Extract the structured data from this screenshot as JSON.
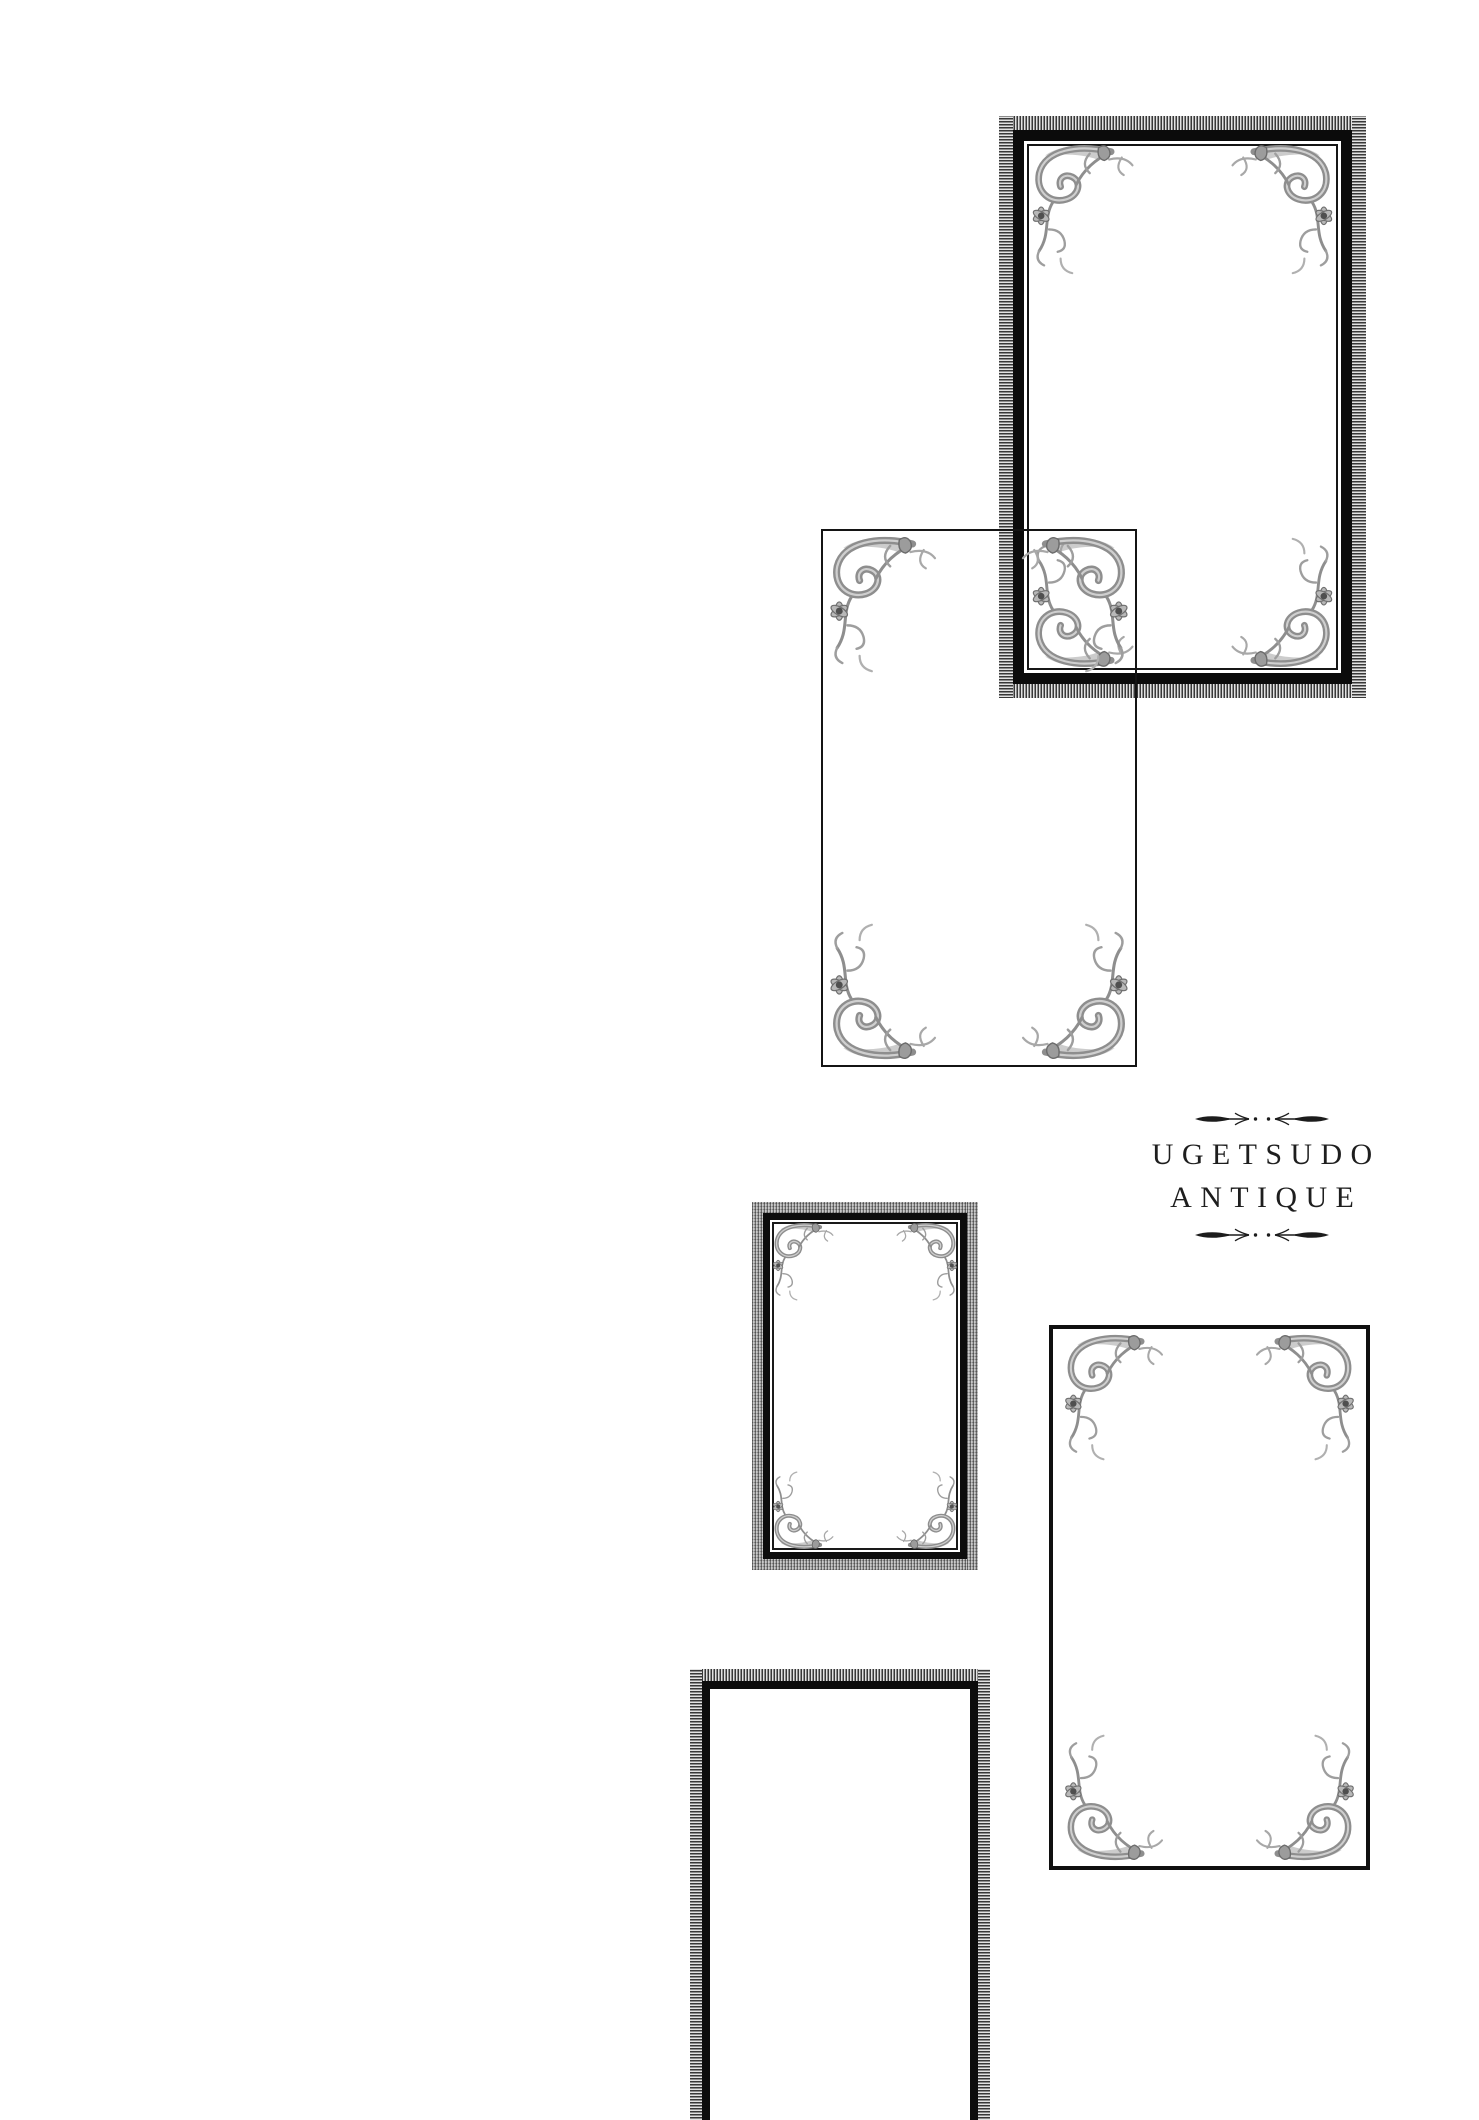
{
  "page": {
    "background": "#ffffff"
  },
  "brand": {
    "name_line1": "UGETSUDO",
    "name_line2": "ANTIQUE",
    "divider_icon": "arrow-dot-divider"
  },
  "icons": {
    "divider": "arrow-dot-divider",
    "corner": "acanthus-corner-flourish"
  },
  "palette": {
    "ink": "#141414",
    "band_gray": "#8c8c8c",
    "ornament_gray": "#8e8e8e",
    "text": "#1e1e1e"
  },
  "frames": [
    {
      "name": "frame-card-1",
      "border_style": "ribbed gray band + heavy black + inner hairline",
      "corner_flourishes": 4
    },
    {
      "name": "frame-card-2",
      "border_style": "hairline, overlaps frame-card-1",
      "corner_flourishes": 4
    },
    {
      "name": "frame-card-3",
      "border_style": "woven gray band + black + inner hairline",
      "corner_flourishes": 4
    },
    {
      "name": "frame-card-4",
      "border_style": "thin black",
      "corner_flourishes": 4
    },
    {
      "name": "frame-card-5",
      "border_style": "ribbed gray band + black, cropped at page bottom",
      "corner_flourishes": 0
    }
  ]
}
